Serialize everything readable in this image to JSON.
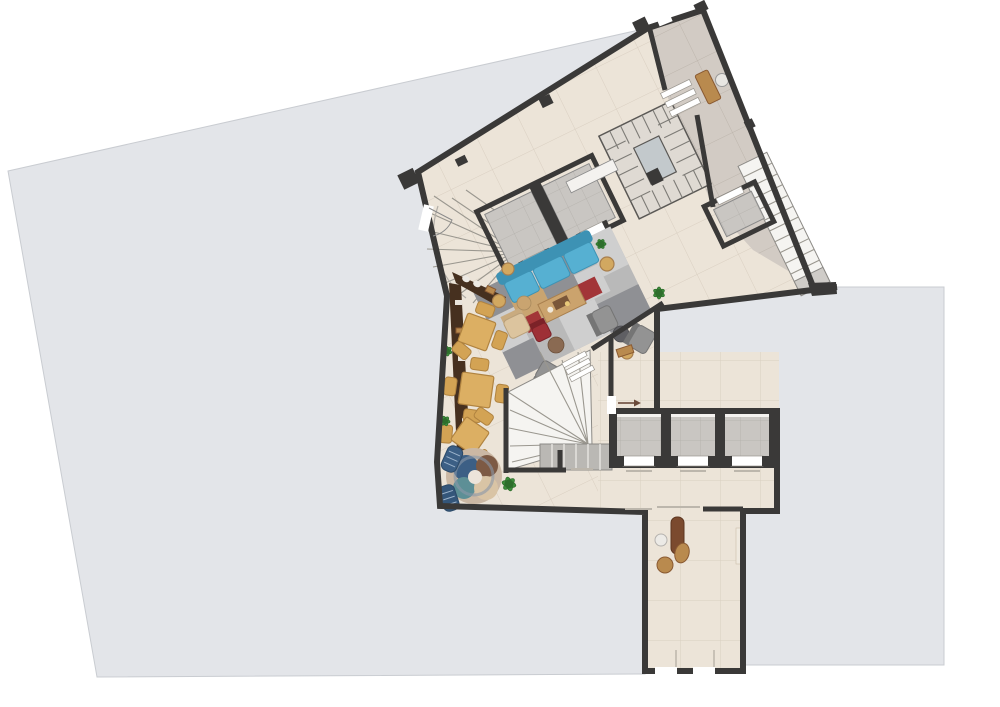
{
  "colors": {
    "page_bg": "#ffffff",
    "wall": "#3a3938",
    "terrace": "#e3e5e9",
    "terrace_edge": "#c9ccd1",
    "floor_main": "#ece4d8",
    "floor_grout": "#d9cfc1",
    "floor_corridor": "#d2cbc4",
    "corridor_grout": "#bdb5ac",
    "elevator_floor": "#c9c6c2",
    "elevator_grout": "#b3b0ab",
    "door_white": "#ffffff",
    "stair_white": "#f5f4f1",
    "stair_gray": "#bab8b4",
    "bar_dark": "#46301f",
    "wood": "#b98a4e",
    "wood_dark": "#8a5a32",
    "table_tan": "#dcaf63",
    "chair_tan": "#d3a354",
    "sofa_blue": "#56b0d2",
    "sofa_blue_dark": "#3d92b4",
    "rug_base": "#b9b9b9",
    "rug_dark": "#8f9094",
    "rug_light": "#cfcfcf",
    "rug_tan": "#c9a470",
    "rug_red": "#a23538",
    "red_chair": "#9e3036",
    "chair_gray": "#939393",
    "chair_gray_dark": "#757575",
    "pouf_brown": "#8a6a52",
    "pouf_dark": "#5f5f63",
    "plant": "#3e8f3c",
    "plant_dark": "#2e6e2c",
    "lounger_blue": "#3c5f85",
    "lounger_blue_dark": "#2c4a68",
    "round_rug_teal": "#5d8f96",
    "round_rug_brown": "#7d5a44",
    "round_rug_beige": "#d9c4a5",
    "corridor_bench_wood": "#7b4a2e"
  },
  "areas": {
    "terrace_left": "left roof terrace",
    "terrace_right": "right roof terrace",
    "main_hall": "main lounge hall",
    "upper_corridor": "upper tilted corridor",
    "elevator_lobby": "elevator lobby",
    "lower_corridor": "lower corridor",
    "vestibule": "vestibule"
  },
  "inventory": {
    "lobby_elevators": 3,
    "upper_elevators": 2,
    "service_elevator": 1,
    "stairs": [
      "entry-winder-stair",
      "central-winder-stair",
      "spiral-stair",
      "external-side-stair"
    ],
    "dining_tables": 3,
    "bar_counters": 1,
    "bar_stools": 2,
    "sofas": 1,
    "armchairs": 5,
    "poufs": 3,
    "plants": 5,
    "rugs": 2,
    "loungers": 2
  }
}
